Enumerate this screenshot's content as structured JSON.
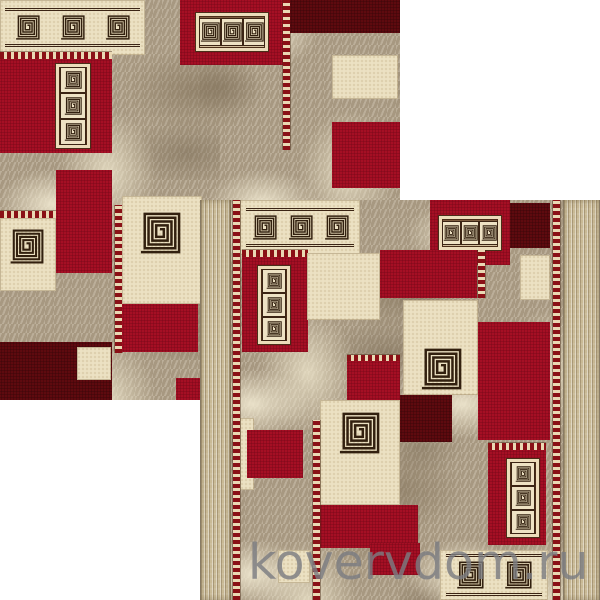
{
  "watermark": {
    "text": "kovervdom.ru",
    "color": "#7b7d81"
  },
  "background": "#ffffff",
  "palette": {
    "field_red": "#b01127",
    "dark_red": "#680b11",
    "cream": "#ece1c3",
    "marble_beige": "#b2a38b",
    "binding_band": "#c9ba96",
    "ornament_red": "#8a1016",
    "meander_line": "#32200f"
  },
  "rugs": [
    {
      "name": "rug-photo-back",
      "left": 0,
      "top": 0,
      "size": 400,
      "borders": false,
      "blocks": [
        {
          "x": 0,
          "y": 0,
          "w": 145,
          "h": 55,
          "f": "cream",
          "m": {
            "t": "row",
            "x": 5,
            "y": 8,
            "w": 135,
            "h": 39,
            "n": 3
          }
        },
        {
          "x": 180,
          "y": 0,
          "w": 103,
          "h": 65,
          "f": "red",
          "m": {
            "t": "framedrow",
            "x": 16,
            "y": 13,
            "w": 72,
            "h": 38,
            "n": 3
          }
        },
        {
          "x": 283,
          "y": 0,
          "w": 7,
          "h": 150,
          "f": "ornv"
        },
        {
          "x": 290,
          "y": 0,
          "w": 110,
          "h": 33,
          "f": "maroon"
        },
        {
          "x": 332,
          "y": 55,
          "w": 66,
          "h": 44,
          "f": "cream"
        },
        {
          "x": 332,
          "y": 122,
          "w": 68,
          "h": 66,
          "f": "red"
        },
        {
          "x": 0,
          "y": 52,
          "w": 112,
          "h": 7,
          "f": "ornh"
        },
        {
          "x": 0,
          "y": 59,
          "w": 112,
          "h": 94,
          "f": "red",
          "m": {
            "t": "framedcol",
            "x": 56,
            "y": 5,
            "w": 34,
            "h": 84,
            "n": 3
          }
        },
        {
          "x": 0,
          "y": 211,
          "w": 56,
          "h": 7,
          "f": "ornh"
        },
        {
          "x": 0,
          "y": 218,
          "w": 56,
          "h": 73,
          "f": "cream",
          "m": {
            "t": "spiral",
            "x": 9,
            "y": 11,
            "s": 35
          }
        },
        {
          "x": 56,
          "y": 170,
          "w": 56,
          "h": 103,
          "f": "red"
        },
        {
          "x": 115,
          "y": 205,
          "w": 7,
          "h": 148,
          "f": "ornv"
        },
        {
          "x": 122,
          "y": 196,
          "w": 80,
          "h": 108,
          "f": "cream",
          "m": {
            "t": "spiral",
            "x": 17,
            "y": 16,
            "s": 42
          }
        },
        {
          "x": 122,
          "y": 304,
          "w": 76,
          "h": 48,
          "f": "red"
        },
        {
          "x": 0,
          "y": 342,
          "w": 112,
          "h": 58,
          "f": "maroon"
        },
        {
          "x": 77,
          "y": 347,
          "w": 34,
          "h": 33,
          "f": "cream"
        },
        {
          "x": 176,
          "y": 378,
          "w": 27,
          "h": 22,
          "f": "red"
        }
      ]
    },
    {
      "name": "rug-photo-front",
      "left": 200,
      "top": 200,
      "size": 400,
      "borders": true,
      "blocks": [
        {
          "x": 40,
          "y": 0,
          "w": 120,
          "h": 55,
          "f": "cream",
          "m": {
            "t": "row",
            "x": 6,
            "y": 8,
            "w": 108,
            "h": 39,
            "n": 3
          }
        },
        {
          "x": 230,
          "y": 0,
          "w": 80,
          "h": 65,
          "f": "red",
          "m": {
            "t": "framedrow",
            "x": 9,
            "y": 16,
            "w": 62,
            "h": 34,
            "n": 3
          }
        },
        {
          "x": 310,
          "y": 3,
          "w": 40,
          "h": 45,
          "f": "maroon"
        },
        {
          "x": 320,
          "y": 55,
          "w": 30,
          "h": 45,
          "f": "cream"
        },
        {
          "x": 42,
          "y": 50,
          "w": 66,
          "h": 7,
          "f": "ornh"
        },
        {
          "x": 42,
          "y": 57,
          "w": 66,
          "h": 95,
          "f": "red",
          "m": {
            "t": "framedcol",
            "x": 16,
            "y": 9,
            "w": 32,
            "h": 78,
            "n": 3
          }
        },
        {
          "x": 107,
          "y": 53,
          "w": 73,
          "h": 67,
          "f": "cream"
        },
        {
          "x": 180,
          "y": 50,
          "w": 97,
          "h": 48,
          "f": "red"
        },
        {
          "x": 278,
          "y": 50,
          "w": 7,
          "h": 48,
          "f": "ornv"
        },
        {
          "x": 203,
          "y": 100,
          "w": 75,
          "h": 95,
          "f": "cream",
          "m": {
            "t": "spiral",
            "x": 17,
            "y": 48,
            "s": 42
          }
        },
        {
          "x": 278,
          "y": 122,
          "w": 72,
          "h": 118,
          "f": "red"
        },
        {
          "x": 147,
          "y": 155,
          "w": 53,
          "h": 6,
          "f": "ornh"
        },
        {
          "x": 147,
          "y": 161,
          "w": 53,
          "h": 39,
          "f": "red"
        },
        {
          "x": 200,
          "y": 195,
          "w": 52,
          "h": 47,
          "f": "maroon"
        },
        {
          "x": 120,
          "y": 200,
          "w": 80,
          "h": 105,
          "f": "cream",
          "m": {
            "t": "spiral",
            "x": 18,
            "y": 12,
            "s": 42
          }
        },
        {
          "x": 120,
          "y": 305,
          "w": 98,
          "h": 43,
          "f": "red"
        },
        {
          "x": 40,
          "y": 218,
          "w": 14,
          "h": 72,
          "f": "cream"
        },
        {
          "x": 47,
          "y": 230,
          "w": 56,
          "h": 48,
          "f": "red"
        },
        {
          "x": 113,
          "y": 220,
          "w": 7,
          "h": 180,
          "f": "ornv"
        },
        {
          "x": 78,
          "y": 350,
          "w": 32,
          "h": 33,
          "f": "cream"
        },
        {
          "x": 170,
          "y": 343,
          "w": 50,
          "h": 32,
          "f": "red"
        },
        {
          "x": 288,
          "y": 243,
          "w": 58,
          "h": 7,
          "f": "ornh"
        },
        {
          "x": 288,
          "y": 250,
          "w": 58,
          "h": 95,
          "f": "red",
          "m": {
            "t": "framedcol",
            "x": 19,
            "y": 9,
            "w": 32,
            "h": 78,
            "n": 3
          }
        },
        {
          "x": 240,
          "y": 350,
          "w": 108,
          "h": 50,
          "f": "cream",
          "m": {
            "t": "row",
            "x": 6,
            "y": 4,
            "w": 96,
            "h": 42,
            "n": 2
          }
        }
      ]
    }
  ]
}
